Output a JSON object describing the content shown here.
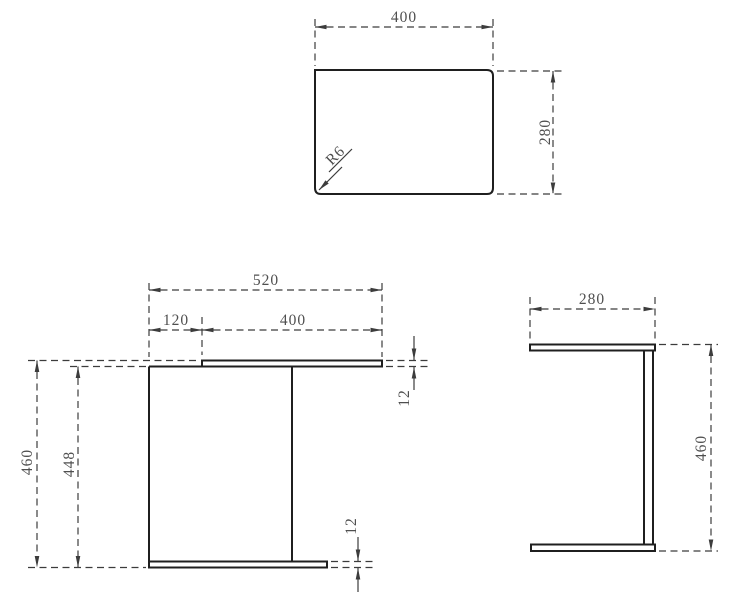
{
  "drawing": {
    "type": "technical-orthographic-drawing",
    "subject": "C-shaped side table, three views",
    "colors": {
      "background": "#ffffff",
      "object_line": "#1f1f1f",
      "dimension_line": "#3c3c3c",
      "text": "#4f4f4f"
    },
    "views": {
      "top": {
        "title": "top view (table top panel)"
      },
      "front": {
        "title": "front view"
      },
      "side": {
        "title": "side view"
      }
    },
    "labels": {
      "top_width": "400",
      "top_depth": "280",
      "corner_radius": "R6",
      "front_overall_width": "520",
      "front_offset": "120",
      "front_panel_width": "400",
      "front_overall_height": "460",
      "front_inner_height": "448",
      "front_top_thickness": "12",
      "front_bottom_thickness": "12",
      "side_depth": "280",
      "side_height": "460"
    }
  }
}
